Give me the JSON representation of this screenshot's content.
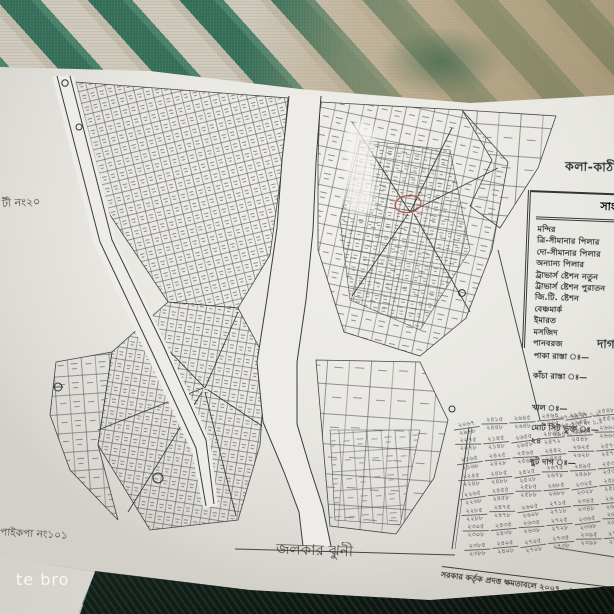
{
  "photo": {
    "watermark": "te bro",
    "fabric": {
      "stripe_green": "#36705a",
      "stripe_cream": "#cfc9ba",
      "tan_fade": "#b4a280",
      "bottom_dark_green": "#2a4f40",
      "shadow": "#0a100c"
    },
    "paper_color": "#e9e8e4",
    "ink_color": "#3a3a3a",
    "marker_red": "#b2584c"
  },
  "map": {
    "title_top_right_partial": "কলা-কাঠী",
    "left_margin_note_partial": "টী নং২০",
    "bottom_left_note_partial": "পাইকপা নং১০১",
    "bottom_center_name_handwritten": "জলকার ঝুনী",
    "bottom_right_note": "সরকার কর্তৃক প্রদত্ত ক্ষমতাবলে ২০০৭ - ২০২৩ সং",
    "section_header_partial": "দাগ"
  },
  "legend": {
    "header_partial": "সাং",
    "items": [
      "মন্দির",
      "ত্রি-সীমানার পিলার",
      "দো-সীমানার পিলার",
      "অন্যান্য পিলার",
      "ট্রাভার্স ষ্টেশন নতুন",
      "ট্রাভার্স ষ্টেশন পুরাতন",
      "জি.টি. ষ্টেশন",
      "বেঞ্চমার্ক",
      "ইমারত",
      "মসজিদ",
      "পানবরজ"
    ]
  },
  "stats": {
    "lines": [
      "পাকা রাস্তা ঃ—",
      "কাঁচা রাস্তা ঃ—",
      "খাল ঃ—",
      "মোট সিট ভুক্ত ঃ— ২৪",
      "ছুট দাগ ঃ—"
    ],
    "handwritten": [
      "২০৬৭-৬৯ মং ১,২",
      "২৪৬৪-২,৫ মং ১,২",
      "২৯৪২, ২৯৬২"
    ]
  },
  "dag_table": {
    "entries": [
      [
        "২০৬৭",
        "২৯৬৮"
      ],
      [
        "২৪১৫",
        "২৪৪৮"
      ],
      [
        "২৬৪৫",
        "২৬৪৮"
      ],
      [
        "২৪৬৪",
        "২৪৬৫"
      ],
      [
        "২৯৪২",
        "২৯৪৫"
      ],
      [
        "২৫৪৮",
        "২৫৫২"
      ],
      [
        "২০৭৫",
        "২০৭৮"
      ],
      [
        "২১৪৫",
        "২১৪৮"
      ],
      [
        "২৬৫৫",
        "২৬৫৮"
      ],
      [
        "২৪৬৮",
        "২৪৭২"
      ],
      [
        "২৫৪৫",
        "২৫৪৮"
      ],
      [
        "২৬৬২",
        "২৬৬৫"
      ],
      [
        "২১৬৫",
        "২১৬৮"
      ],
      [
        "২৪২৫",
        "২৪২৮"
      ],
      [
        "২৫৬৫",
        "২৫৬৮"
      ],
      [
        "২৪৪২",
        "২৪৪৫"
      ],
      [
        "২৬২৫",
        "২৬২৮"
      ],
      [
        "২৫৭৫",
        "২৫৭৮"
      ],
      [
        "২২৪৫",
        "২২৪৮"
      ],
      [
        "২৪৮৫",
        "২৪৮৮"
      ],
      [
        "২৫২৫",
        "২৫২৮"
      ],
      [
        "২৬৭৫",
        "২৬৭৮"
      ],
      [
        "২৪৯৫",
        "২৪৯৮"
      ],
      [
        "২৫৩৫",
        "২৫৩৮"
      ],
      [
        "২২৬৫",
        "২২৬৮"
      ],
      [
        "২৪৫৫",
        "২৪৫৮"
      ],
      [
        "২৫৮৫",
        "২৫৮৮"
      ],
      [
        "২৬৮৫",
        "২৬৮৮"
      ],
      [
        "২৩২৫",
        "২৩২৮"
      ],
      [
        "২৫৯৫",
        "২৫৯৮"
      ],
      [
        "২২৮৫",
        "২২৮৮"
      ],
      [
        "২৪৭৫",
        "২৪৭৮"
      ],
      [
        "২৬০৫",
        "২৬০৮"
      ],
      [
        "২৭১৫",
        "২৭১৮"
      ],
      [
        "২৩৪৫",
        "২৩৪৮"
      ],
      [
        "২৬১৫",
        "২৬১৮"
      ],
      [
        "২৩০৫",
        "২৩০৮"
      ],
      [
        "২৪৩৫",
        "২৪৩৮"
      ],
      [
        "২৬৩৫",
        "২৬৩৮"
      ],
      [
        "২৭২৫",
        "২৭২৮"
      ],
      [
        "২৩৬৫",
        "২৩৬৮"
      ],
      [
        "২৬৯৫",
        "২৬৯৮"
      ],
      [
        "২৩৮৫",
        "২৩৮৮"
      ],
      [
        "২৪০৫",
        "২৪০৮"
      ],
      [
        "২৭০৫",
        "২৭০৮"
      ],
      [
        "২৭৩৫",
        "২৭৩৮"
      ],
      [
        "২৩৯৫",
        "২৩৯৮"
      ],
      [
        "২৭৪৫",
        "২৭৪৮"
      ]
    ]
  }
}
